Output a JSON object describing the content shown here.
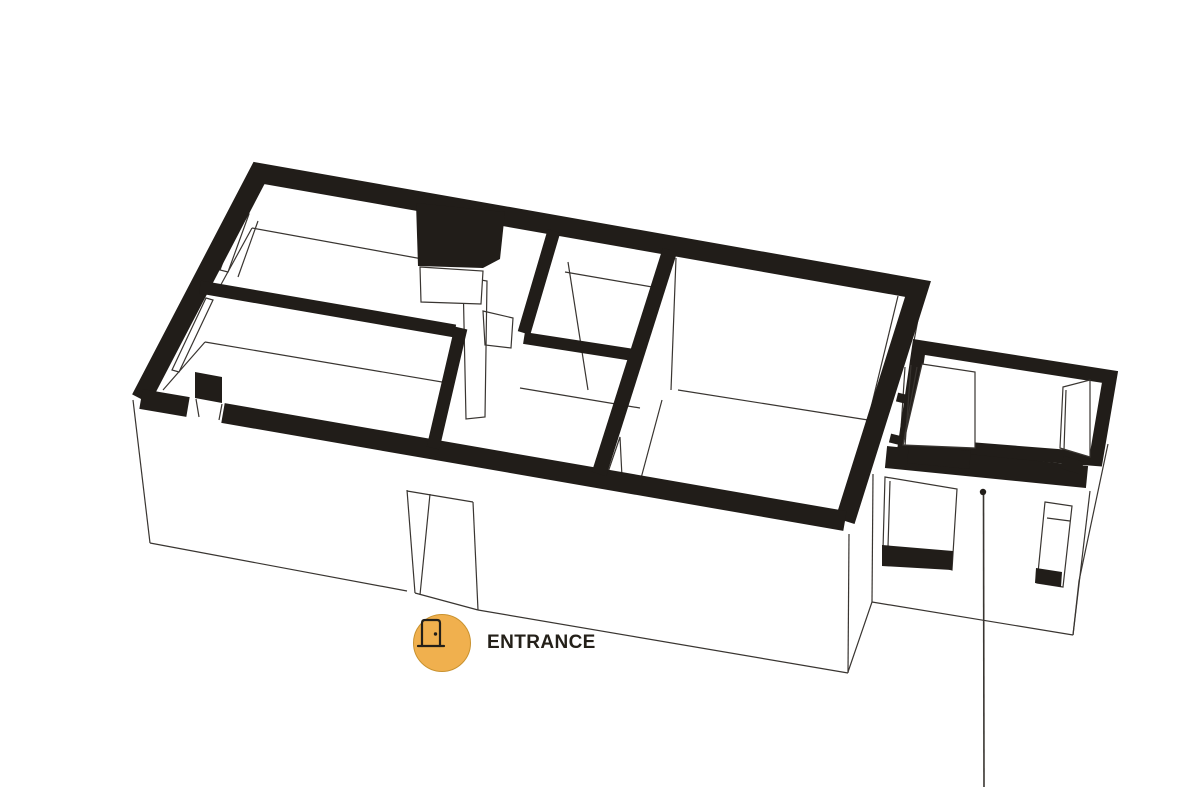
{
  "scene": {
    "description": "Black-and-white 3D axonometric floor plan of an apartment. Cut wall tops are filled solid black, wall faces are white with thin outlines. A small annex room with window openings sits at the right. A thin vertical leader line with a dot points from the annex front wall down to the bottom edge of the image. An orange circular badge with a door icon marks the entrance opening in the front wall.",
    "background": "#ffffff"
  },
  "colors": {
    "ink": "#211d19",
    "line": "#393531",
    "badge-fill": "#f0b04e",
    "badge-border": "#c9922f",
    "label": "#242019"
  },
  "entrance": {
    "label": "ENTRANCE",
    "icon": "door-icon"
  }
}
